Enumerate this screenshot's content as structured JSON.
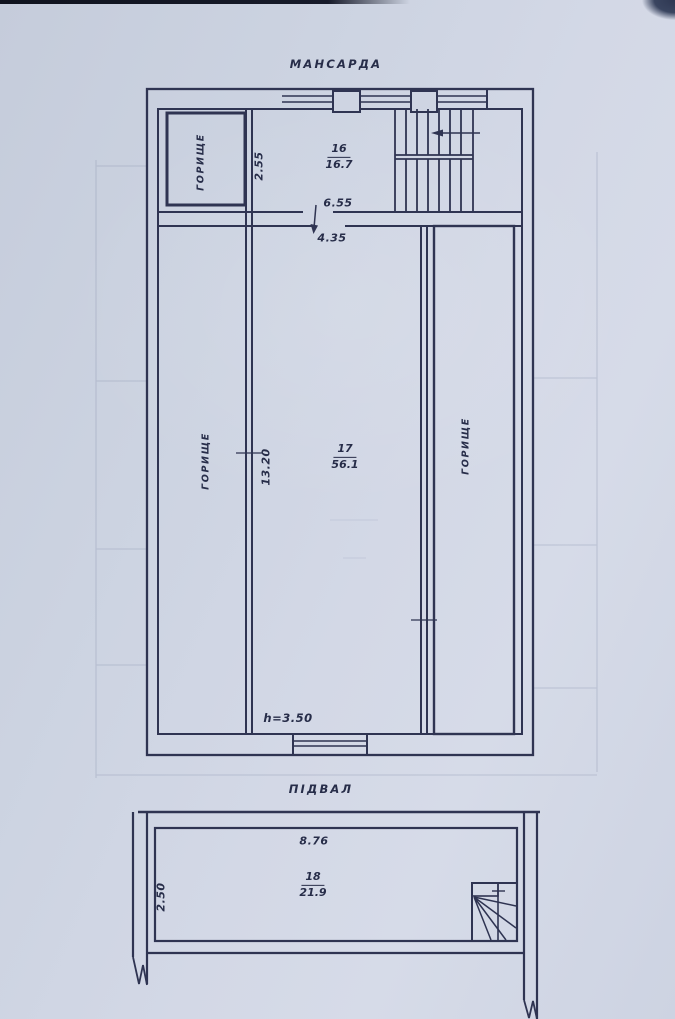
{
  "colors": {
    "paper": "#ccd3e1",
    "ink": "#2c3250"
  },
  "mansard": {
    "title": "МАНСАРДА",
    "attic_top_left": "ГОРИЩЕ",
    "attic_left": "ГОРИЩЕ",
    "attic_right": "ГОРИЩЕ",
    "room16": {
      "number": "16",
      "area": "16.7"
    },
    "room17": {
      "number": "17",
      "area": "56.1"
    },
    "dims": {
      "room16_width": "2.55",
      "opening_top": "6.55",
      "opening_bottom": "4.35",
      "room17_length": "13.20"
    },
    "height_note": "h=3.50"
  },
  "basement": {
    "title": "ПІДВАЛ",
    "room18": {
      "number": "18",
      "area": "21.9"
    },
    "dims": {
      "width": "8.76",
      "depth": "2.50"
    }
  }
}
